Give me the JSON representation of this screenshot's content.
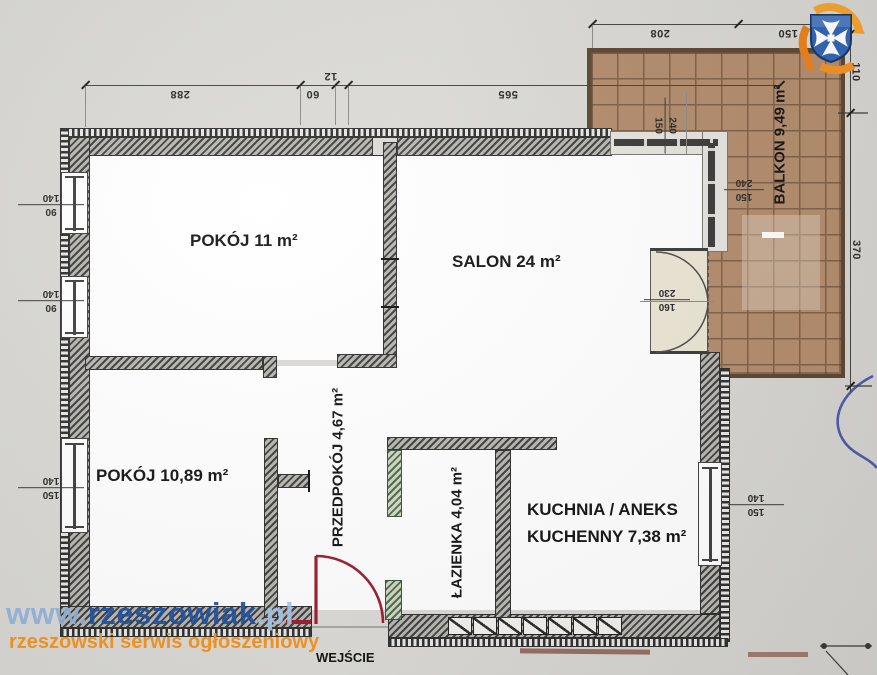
{
  "plan": {
    "rooms": {
      "pokoj1": "POKÓJ 11 m²",
      "salon": "SALON 24 m²",
      "pokoj2": "POKÓJ 10,89 m²",
      "przedpokoj": "PRZEDPOKÓJ 4,67 m²",
      "lazienka": "ŁAZIENKA 4,04 m²",
      "kuchnia_line1": "KUCHNIA / ANEKS",
      "kuchnia_line2": "KUCHENNY 7,38 m²",
      "balkon": "BALKON 9,49 m²",
      "wejscie": "WEJŚCIE"
    },
    "dims": {
      "top288": "288",
      "top60": "60",
      "top12": "12",
      "top565": "565",
      "bal208": "208",
      "bal150": "150",
      "right110": "110",
      "right370": "370",
      "winA_w": "140",
      "winA_h": "90",
      "winB_w": "140",
      "winB_h": "90",
      "winC_w": "140",
      "winC_h": "150",
      "winR_w": "140",
      "winR_h": "150",
      "salonTop_a": "150",
      "salonTop_b": "240",
      "salonSide_a": "240",
      "salonSide_b": "150",
      "balDoor_a": "230",
      "balDoor_b": "160"
    }
  },
  "watermark": {
    "www": "www.",
    "name": "rzeszowiak",
    "tld": ".pl",
    "subtitle": "rzeszowski serwis ogłoszeniowy"
  },
  "colors": {
    "paper": "#d8d7d2",
    "balcony_fill": "#b28b6c",
    "balcony_grid": "#7f5f47",
    "wall": "#3f3f3f",
    "entrance_door": "#9c1b2e",
    "bath_door_frame": "#5e7a52",
    "watermark_navy": "#1d4f9e",
    "watermark_lightblue": "#8fb3dc",
    "watermark_orange": "#f5941d",
    "pen": "#3d4da1",
    "logo_blue": "#2f63b4",
    "logo_orange": "#f19122"
  }
}
